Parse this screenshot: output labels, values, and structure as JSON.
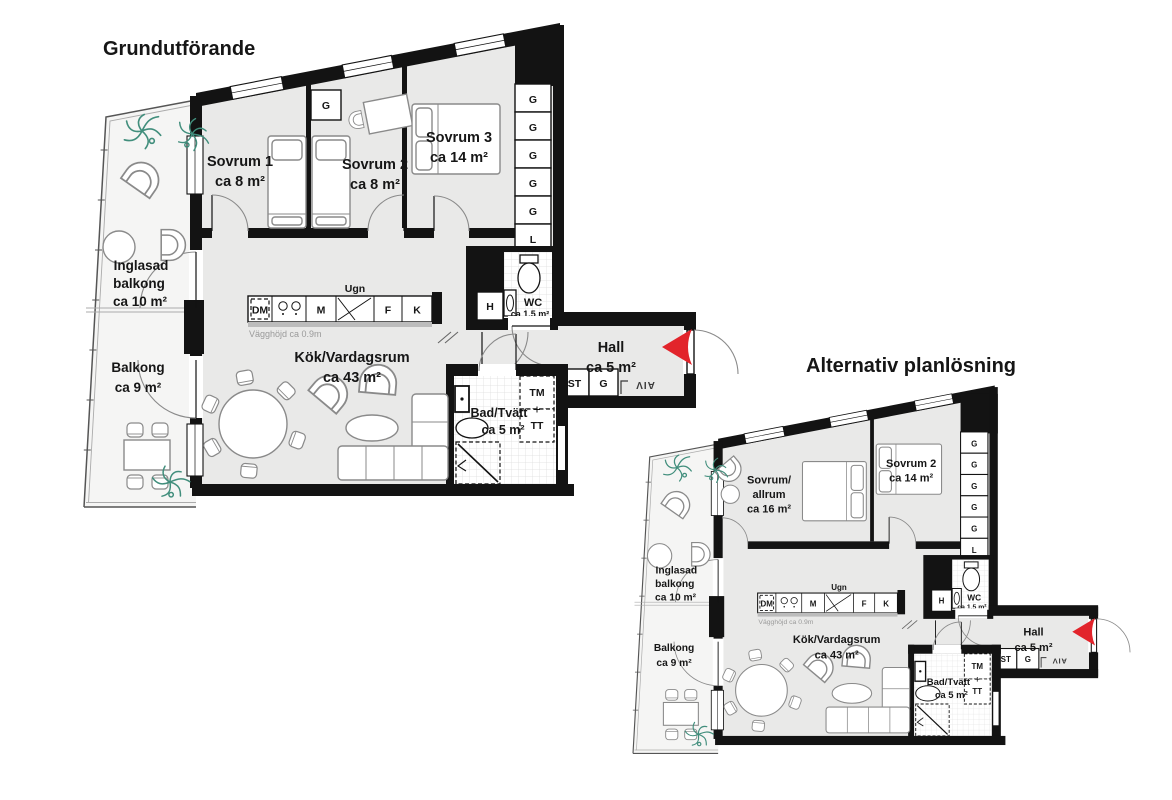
{
  "colors": {
    "wall": "#131313",
    "floor_gray": "#e9e9e8",
    "balcony_floor": "#f5f5f4",
    "entry_arrow_red": "#e2242b",
    "plant_green": "#418e7c",
    "furniture_stroke": "#8a8a8a",
    "note_gray": "#9a9a9a"
  },
  "plan1": {
    "title": "Grundutförande",
    "rooms": {
      "sovrum1": {
        "name": "Sovrum 1",
        "area": "ca 8 m²"
      },
      "sovrum2": {
        "name": "Sovrum 2",
        "area": "ca 8 m²"
      },
      "sovrum3": {
        "name": "Sovrum 3",
        "area": "ca 14 m²"
      },
      "inglasad_balkong": {
        "line1": "Inglasad",
        "line2": "balkong",
        "area": "ca 10 m²"
      },
      "balkong": {
        "name": "Balkong",
        "area": "ca 9 m²"
      },
      "kok_vardagsrum": {
        "name": "Kök/Vardagsrum",
        "area": "ca 43 m²"
      },
      "bad_tvatt": {
        "name": "Bad/Tvätt",
        "area": "ca 5 m²"
      },
      "wc": {
        "name": "WC",
        "area": "ca 1.5 m²"
      },
      "hall": {
        "name": "Hall",
        "area": "ca 5 m²"
      }
    },
    "fixtures": {
      "dm": "DM",
      "m": "M",
      "ugn": "Ugn",
      "f": "F",
      "k": "K",
      "g": "G",
      "l": "L",
      "h": "H",
      "st": "ST",
      "tm": "TM",
      "tt": "TT",
      "vent": "AIV",
      "wall_height_note": "Vägghöjd ca 0.9m"
    }
  },
  "plan2": {
    "title": "Alternativ planlösning",
    "rooms": {
      "sovrum_allrum": {
        "line1": "Sovrum/",
        "line2": "allrum",
        "area": "ca 16 m²"
      },
      "sovrum2": {
        "name": "Sovrum 2",
        "area": "ca 14 m²"
      },
      "inglasad_balkong": {
        "line1": "Inglasad",
        "line2": "balkong",
        "area": "ca 10 m²"
      },
      "balkong": {
        "name": "Balkong",
        "area": "ca 9 m²"
      },
      "kok_vardagsrum": {
        "name": "Kök/Vardagsrum",
        "area": "ca 43 m²"
      },
      "bad_tvatt": {
        "name": "Bad/Tvätt",
        "area": "ca 5 m²"
      },
      "wc": {
        "name": "WC",
        "area": "ca 1.5 m²"
      },
      "hall": {
        "name": "Hall",
        "area": "ca 5 m²"
      }
    },
    "fixtures": {
      "dm": "DM",
      "m": "M",
      "ugn": "Ugn",
      "f": "F",
      "k": "K",
      "g": "G",
      "l": "L",
      "h": "H",
      "st": "ST",
      "tm": "TM",
      "tt": "TT",
      "vent": "AIV",
      "wall_height_note": "Vägghöjd ca 0.9m"
    }
  }
}
